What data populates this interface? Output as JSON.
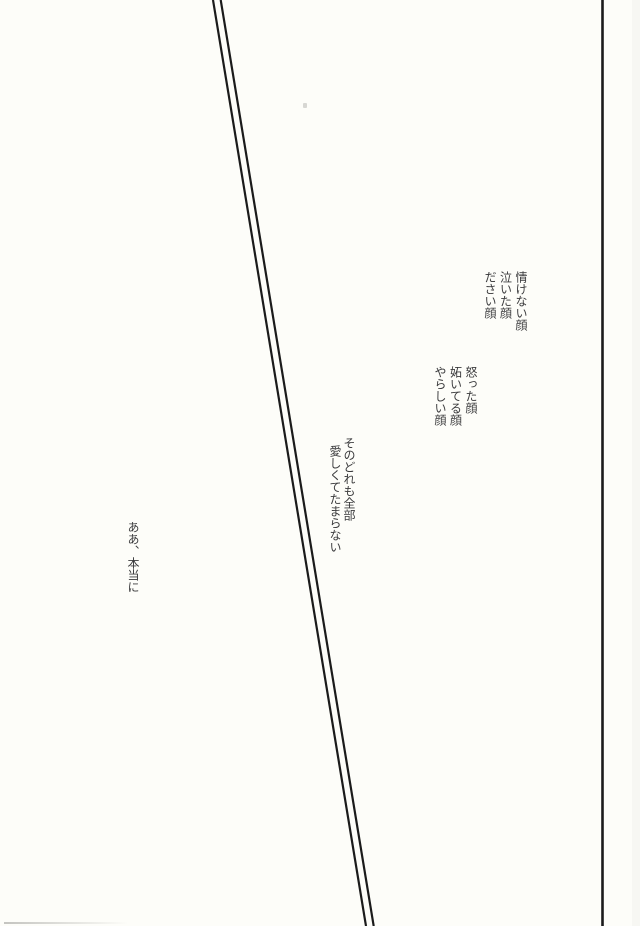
{
  "page": {
    "background_color": "#fdfdf9",
    "text_color": "#3b3b3d",
    "rule_color": "#1b1b1b"
  },
  "text_blocks": {
    "faces_plain": {
      "lines": [
        "情けない顔",
        "泣いた顔",
        "ださい顔"
      ]
    },
    "faces_emotive": {
      "lines": [
        "怒った顔",
        "妬いてる顔",
        "やらしい顔"
      ]
    },
    "confession": {
      "lines": [
        "そのどれも全部",
        "愛しくてたまらない"
      ]
    },
    "sigh": {
      "lines": [
        "ああ、本当に"
      ]
    }
  }
}
